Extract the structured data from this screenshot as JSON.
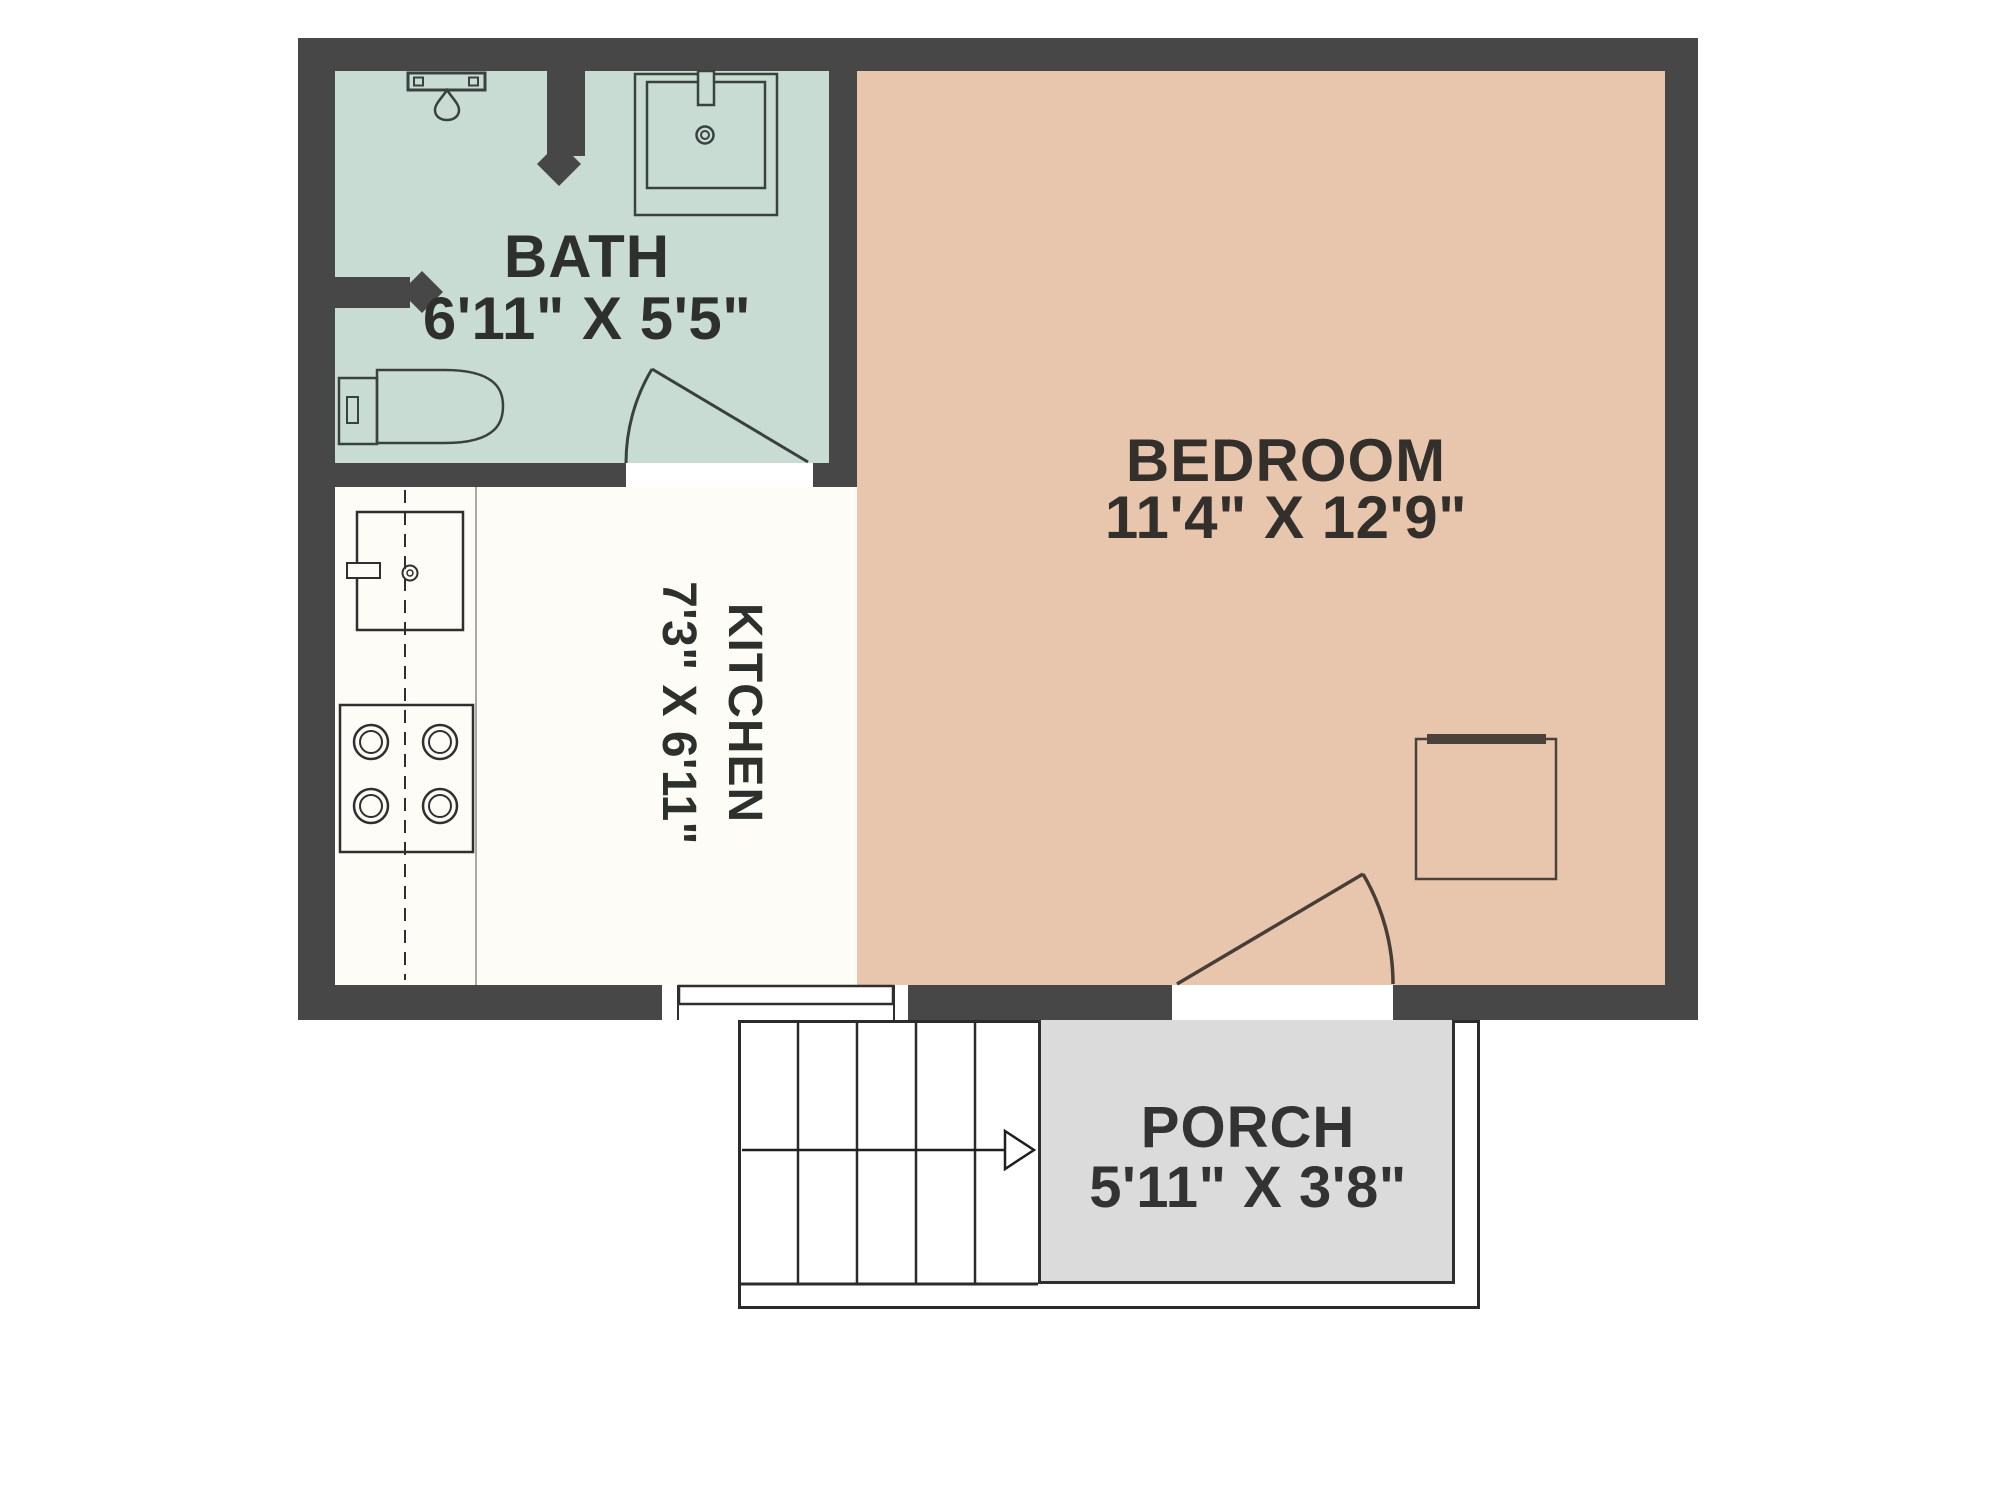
{
  "plan": {
    "title": "Studio apartment floor plan",
    "rooms": [
      {
        "id": "bath",
        "name": "BATH",
        "dims": "6'11\" X 5'5\"",
        "floor_color": "#c9dcd4"
      },
      {
        "id": "bedroom",
        "name": "BEDROOM",
        "dims": "11'4\" X 12'9\"",
        "floor_color": "#e8c6ae"
      },
      {
        "id": "kitchen",
        "name": "KITCHEN",
        "dims": "7'3\" X 6'11\"",
        "floor_color": "#fdfcf6"
      },
      {
        "id": "porch",
        "name": "PORCH",
        "dims": "5'11\" X 3'8\"",
        "floor_color": "#dbdbdb"
      }
    ],
    "colors": {
      "wall": "#474747",
      "fixture_line": "#3a423f",
      "outline": "#2b2b2b",
      "text": "#2d302d"
    },
    "icons": [
      "shower-icon",
      "sink-icon",
      "toilet-icon",
      "kitchen-sink-icon",
      "stove-icon",
      "nightstand-icon",
      "stairs-icon",
      "direction-arrow-icon",
      "door-swing-icon",
      "sliding-door-icon",
      "wall-break-icon"
    ]
  }
}
